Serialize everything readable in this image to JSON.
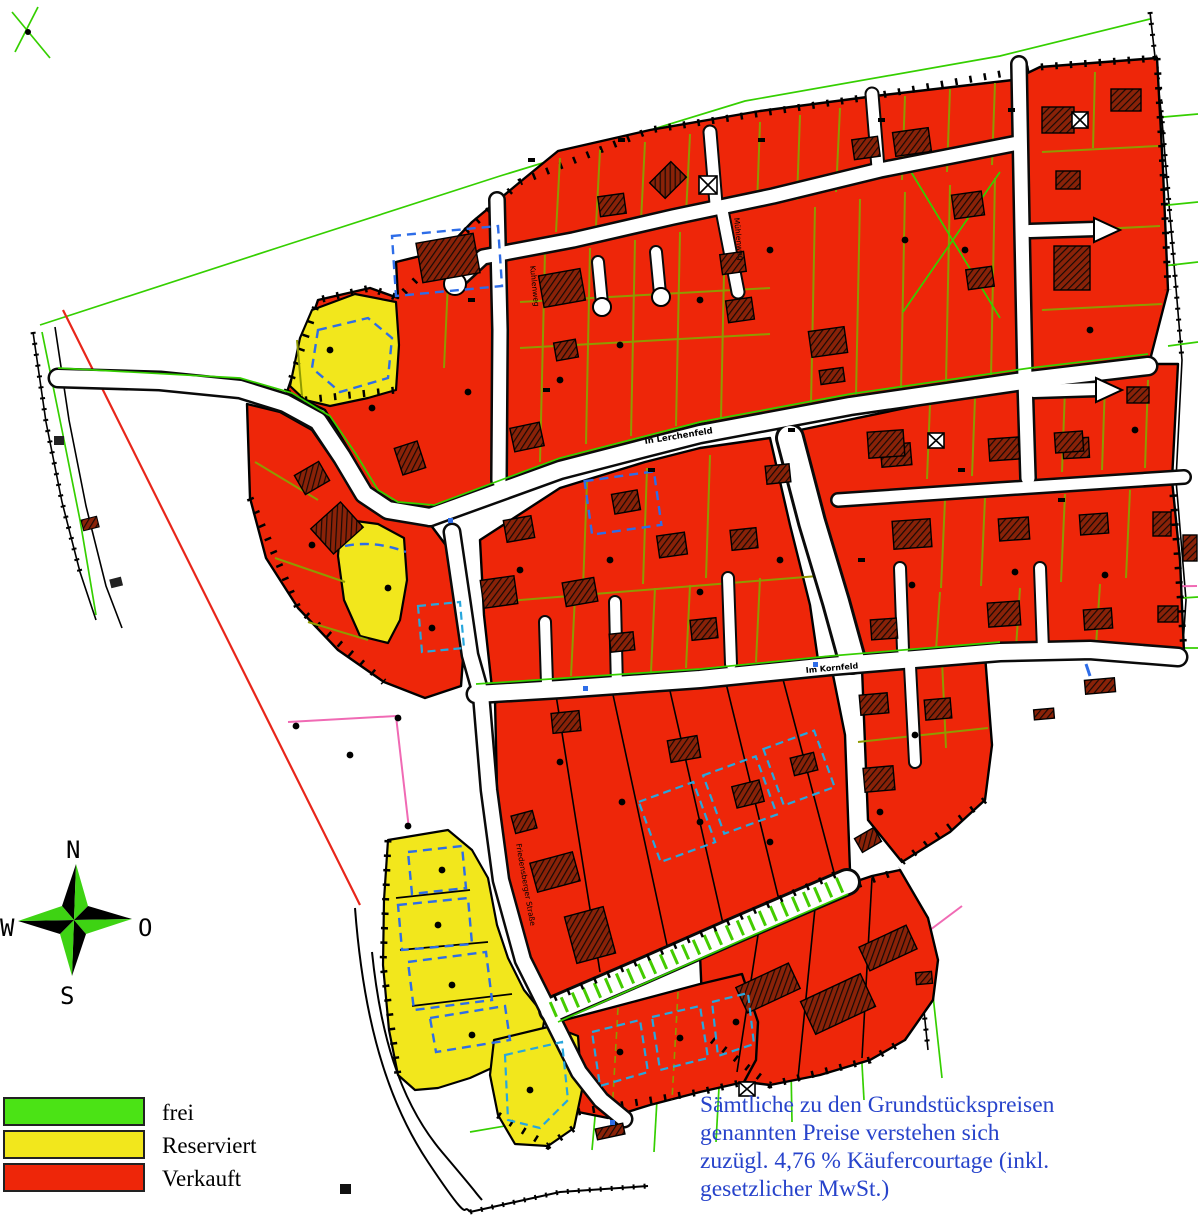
{
  "legend": {
    "items": [
      {
        "label": "frei",
        "color": "#4be315"
      },
      {
        "label": "Reserviert",
        "color": "#f2e71c"
      },
      {
        "label": "Verkauft",
        "color": "#ee2609"
      }
    ]
  },
  "compass": {
    "north": "N",
    "east": "O",
    "south": "S",
    "west": "W"
  },
  "streets": {
    "in_lerchenfeld": "In Lerchenfeld",
    "im_kornfeld": "Im Kornfeld",
    "kuhlenweg": "Kuhlenweg",
    "muehlenweg": "Mühlenweg",
    "friedensberger": "Friedensberger Straße"
  },
  "note": {
    "color": "#2743cb",
    "line1": "Sämtliche zu den Grundstückspreisen",
    "line2": "genannten Preise verstehen sich",
    "line3": "zuzügl. 4,76 % Käufercourtage (inkl.",
    "line4": "gesetzlicher MwSt.)"
  },
  "plot_status_colors": {
    "frei": "#4be315",
    "reserviert": "#f2e71c",
    "verkauft": "#ee2609"
  }
}
